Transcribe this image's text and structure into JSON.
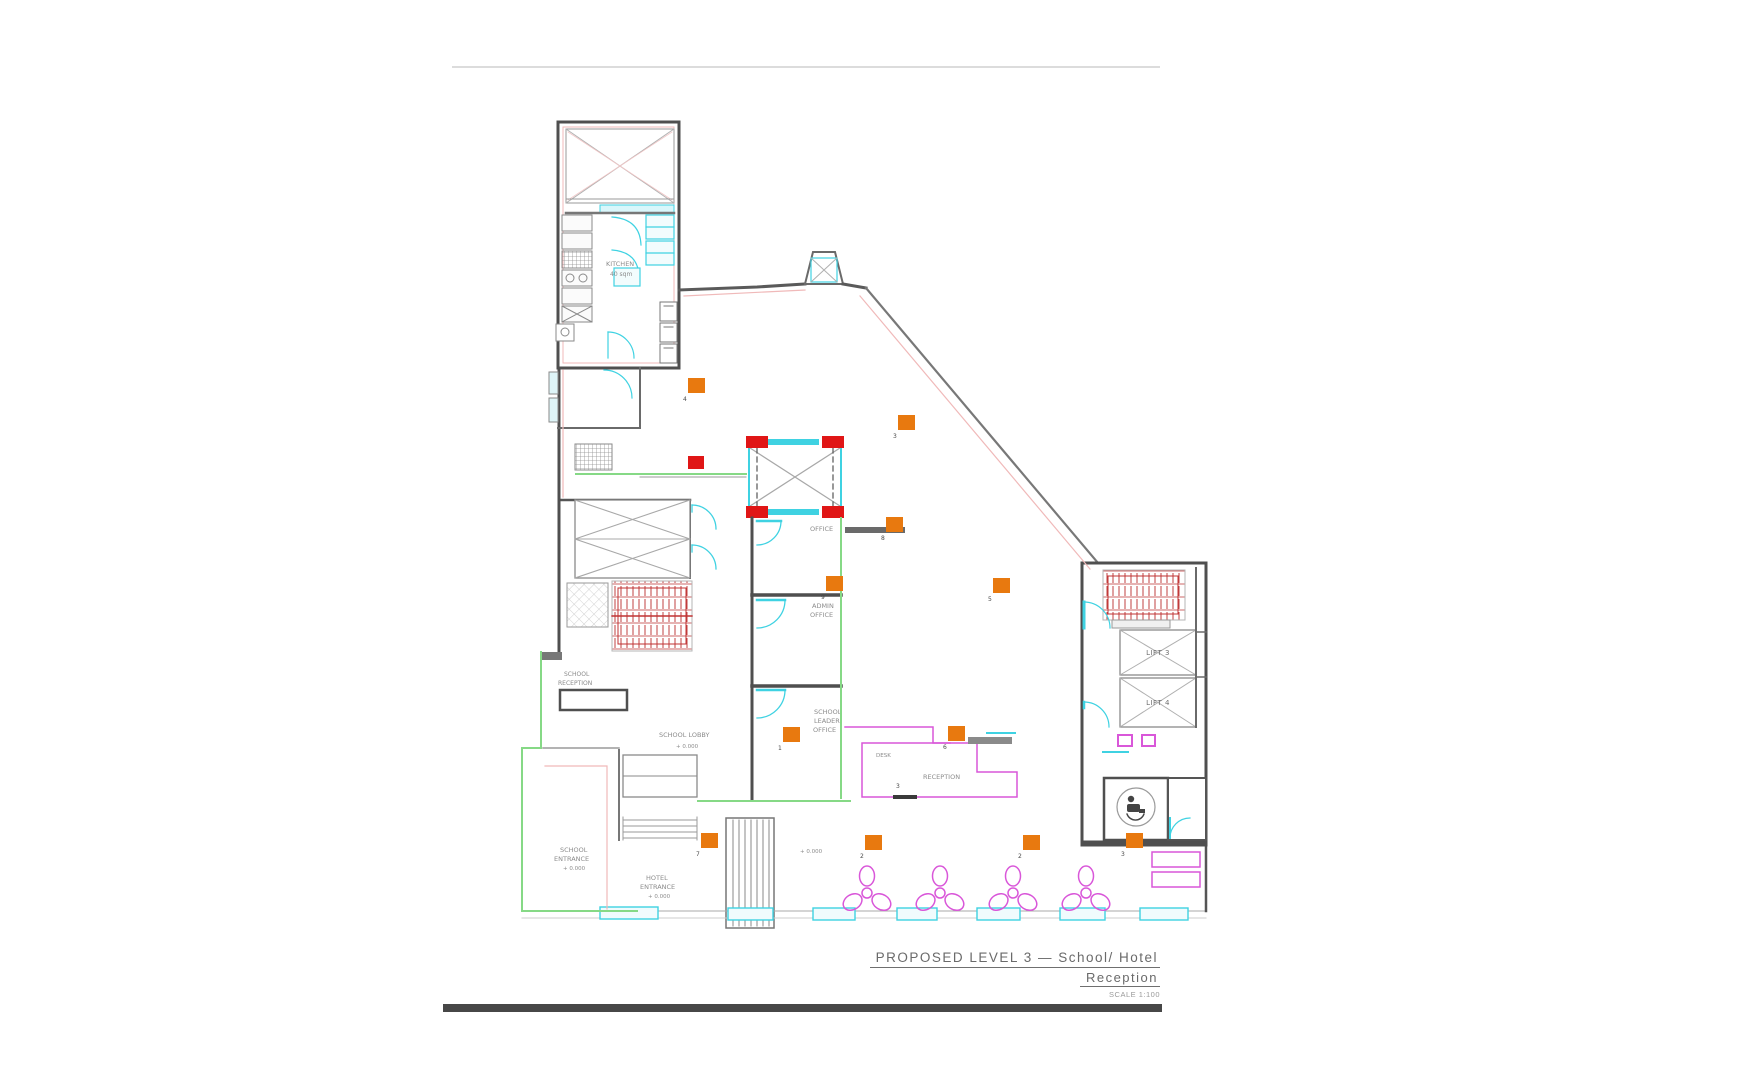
{
  "title": {
    "line1": "PROPOSED LEVEL 3 — School/ Hotel",
    "line2": "Reception",
    "scale": "SCALE 1:100"
  },
  "labels": {
    "kitchen_l1": "KITCHEN",
    "kitchen_l2": "40 sqm",
    "office": "OFFICE",
    "admin_l1": "ADMIN",
    "admin_l2": "OFFICE",
    "leader_l1": "SCHOOL",
    "leader_l2": "LEADER",
    "leader_l3": "OFFICE",
    "school_reception_l1": "SCHOOL",
    "school_reception_l2": "RECEPTION",
    "school_lobby": "SCHOOL LOBBY",
    "school_entrance_l1": "SCHOOL",
    "school_entrance_l2": "ENTRANCE",
    "hotel_entrance_l1": "HOTEL",
    "hotel_entrance_l2": "ENTRANCE",
    "reception": "RECEPTION",
    "desk": "DESK",
    "lift3": "LIFT 3",
    "lift4": "LIFT 4"
  },
  "levels": {
    "lobby": "+ 0.000",
    "school_entrance": "+ 0.000",
    "hotel_entrance": "+ 0.000",
    "hall": "+ 0.000"
  },
  "markers": {
    "o1": "4",
    "o2": "3",
    "o3": "9",
    "o4": "5",
    "o5": "1",
    "o6": "6",
    "o7": "7",
    "o8": "2",
    "o9": "2",
    "o10": "3",
    "o11": "8",
    "r1": "3"
  },
  "colors": {
    "wall": "#4f4f4f",
    "red": "#e01616",
    "orange": "#e8790f",
    "magenta": "#d957d9",
    "cyan": "#3fd2e2",
    "green": "#86d986",
    "pink": "#f0b9b9"
  }
}
